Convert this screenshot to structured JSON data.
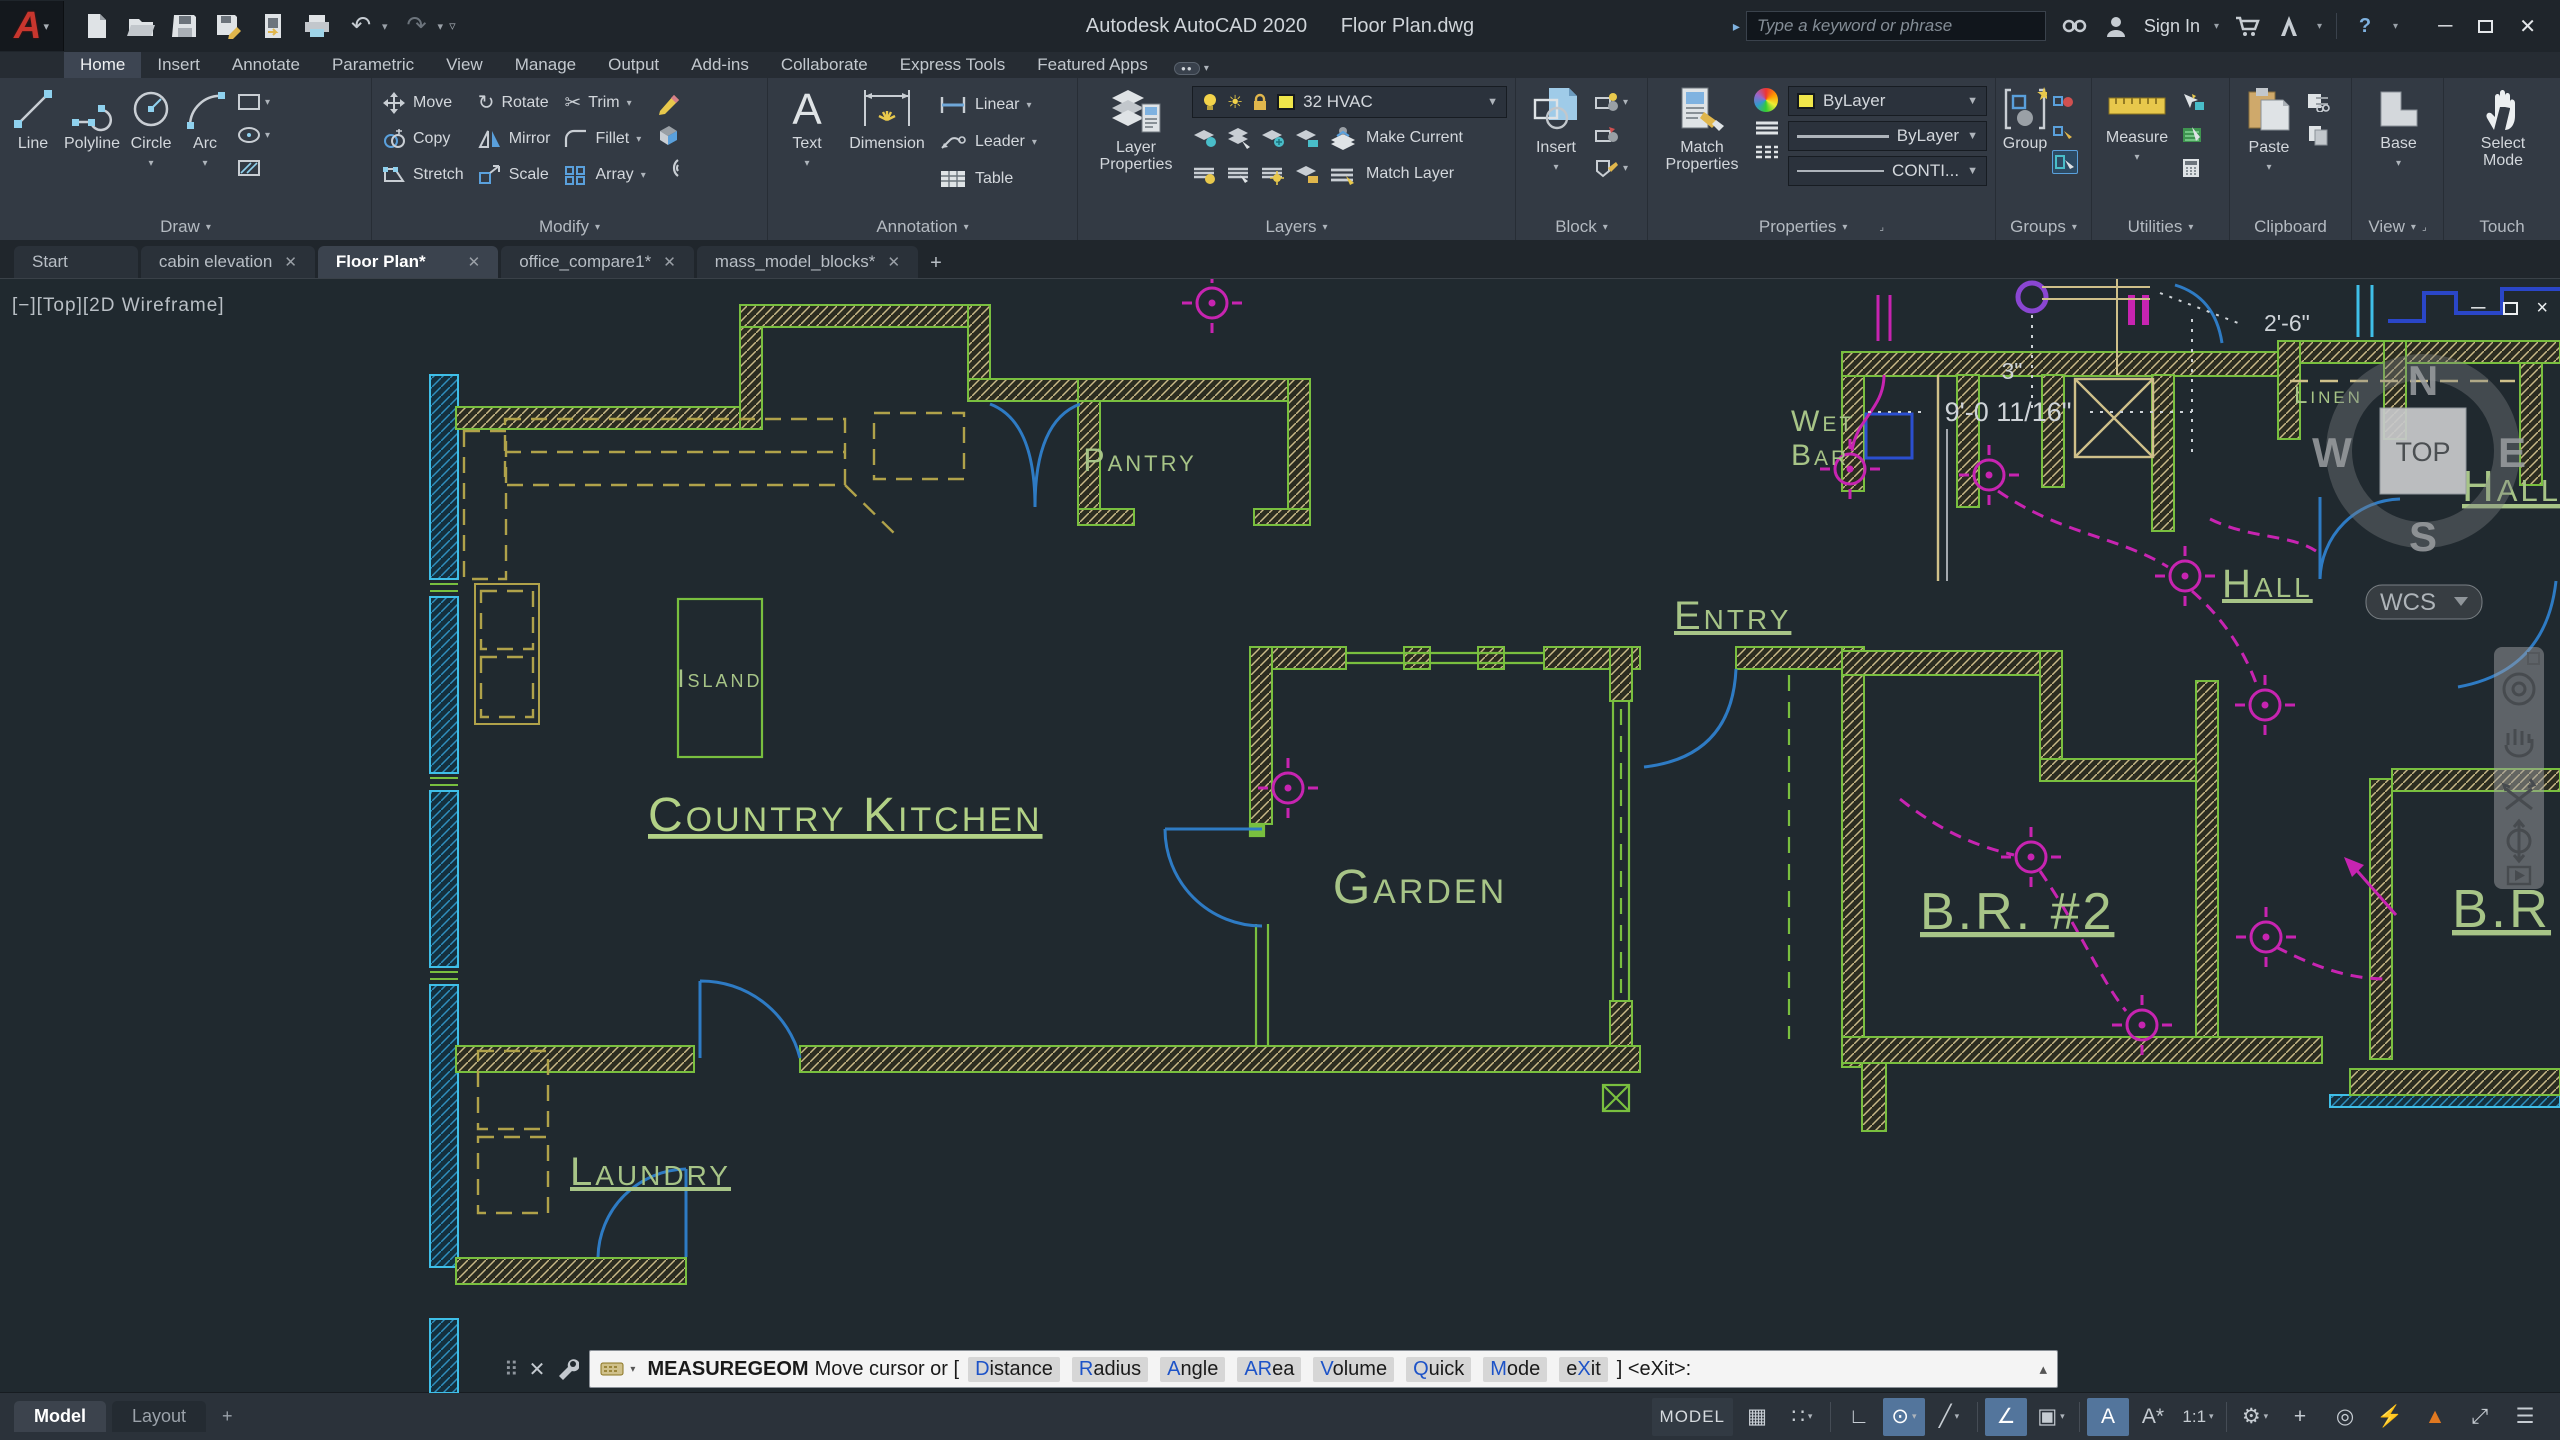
{
  "titlebar": {
    "app_title": "Autodesk AutoCAD 2020",
    "doc_title": "Floor Plan.dwg",
    "search_placeholder": "Type a keyword or phrase",
    "sign_in_label": "Sign In",
    "icons": [
      "application-menu",
      "new",
      "open",
      "save",
      "save-as",
      "export",
      "print",
      "undo",
      "redo",
      "customize",
      "search",
      "binoculars",
      "user",
      "cart",
      "exchange",
      "help",
      "minimize",
      "maximize",
      "close"
    ]
  },
  "ribbon_tabs": [
    {
      "label": "Home",
      "active": true
    },
    {
      "label": "Insert"
    },
    {
      "label": "Annotate"
    },
    {
      "label": "Parametric"
    },
    {
      "label": "View"
    },
    {
      "label": "Manage"
    },
    {
      "label": "Output"
    },
    {
      "label": "Add-ins"
    },
    {
      "label": "Collaborate"
    },
    {
      "label": "Express Tools"
    },
    {
      "label": "Featured Apps"
    }
  ],
  "ribbon": {
    "draw": {
      "title": "Draw",
      "line": "Line",
      "polyline": "Polyline",
      "circle": "Circle",
      "arc": "Arc"
    },
    "modify": {
      "title": "Modify",
      "move": "Move",
      "copy": "Copy",
      "stretch": "Stretch",
      "rotate": "Rotate",
      "mirror": "Mirror",
      "scale": "Scale",
      "trim": "Trim",
      "fillet": "Fillet",
      "array": "Array"
    },
    "annotation": {
      "title": "Annotation",
      "text": "Text",
      "dimension": "Dimension",
      "linear": "Linear",
      "leader": "Leader",
      "table": "Table"
    },
    "layers": {
      "title": "Layers",
      "layer_properties": "Layer Properties",
      "current_layer": "32 HVAC",
      "make_current": "Make Current",
      "match_layer": "Match Layer"
    },
    "block": {
      "title": "Block",
      "insert": "Insert"
    },
    "properties": {
      "title": "Properties",
      "match_properties": "Match Properties",
      "color": "ByLayer",
      "lineweight": "ByLayer",
      "linetype": "CONTI..."
    },
    "groups": {
      "title": "Groups",
      "group": "Group"
    },
    "utilities": {
      "title": "Utilities",
      "measure": "Measure"
    },
    "clipboard": {
      "title": "Clipboard",
      "paste": "Paste"
    },
    "view": {
      "title": "View",
      "base": "Base"
    },
    "touch": {
      "title": "Touch",
      "select_mode": "Select Mode"
    }
  },
  "file_tabs": [
    {
      "label": "Start"
    },
    {
      "label": "cabin elevation"
    },
    {
      "label": "Floor Plan*",
      "active": true
    },
    {
      "label": "office_compare1*"
    },
    {
      "label": "mass_model_blocks*"
    }
  ],
  "viewport": {
    "view_controls": "[−][Top][2D Wireframe]",
    "viewcube": {
      "top": "TOP",
      "north": "N",
      "south": "S",
      "east": "E",
      "west": "W",
      "wcs": "WCS"
    },
    "labels": {
      "pantry": "Pantry",
      "island": "Island",
      "country_kitchen": "Country Kitchen",
      "garden": "Garden",
      "entry": "Entry",
      "laundry": "Laundry",
      "wet": "Wet",
      "bar": "Bar",
      "hall": "Hall",
      "br2": "B.R. #2",
      "br_edge": "B.R",
      "linen": "Linen",
      "hall_edge": "Hall B"
    },
    "dimensions": {
      "dim1": "2'-6\"",
      "dim2": "3\"",
      "dim3": "9'-0 11/16\""
    }
  },
  "command_line": {
    "command": "MEASUREGEOM",
    "prompt_prefix": "Move cursor or [",
    "options": [
      {
        "pre": "",
        "hot": "D",
        "post": "istance"
      },
      {
        "pre": "",
        "hot": "R",
        "post": "adius"
      },
      {
        "pre": "",
        "hot": "A",
        "post": "ngle"
      },
      {
        "pre": "",
        "hot": "AR",
        "post": "ea"
      },
      {
        "pre": "",
        "hot": "V",
        "post": "olume"
      },
      {
        "pre": "",
        "hot": "Q",
        "post": "uick"
      },
      {
        "pre": "",
        "hot": "M",
        "post": "ode"
      },
      {
        "pre": "e",
        "hot": "X",
        "post": "it"
      }
    ],
    "prompt_suffix": "] <eXit>:"
  },
  "status_bar": {
    "model_tab": "Model",
    "layout_tab": "Layout",
    "model_badge": "MODEL",
    "icons": [
      {
        "name": "grid",
        "glyph": "▦"
      },
      {
        "name": "snap",
        "glyph": "∷"
      },
      {
        "name": "ortho",
        "glyph": "∟"
      },
      {
        "name": "polar-tracking",
        "glyph": "⊙",
        "active": true
      },
      {
        "name": "isometric-drafting",
        "glyph": "╱"
      },
      {
        "name": "object-snap-tracking",
        "glyph": "∠",
        "active": true
      },
      {
        "name": "object-snap",
        "glyph": "▣"
      },
      {
        "name": "annotation-visibility",
        "glyph": "A",
        "active": true
      },
      {
        "name": "annotation-autoscale",
        "glyph": "A*"
      },
      {
        "name": "annotation-scale",
        "glyph": "1:1"
      },
      {
        "name": "workspace",
        "glyph": "⚙"
      },
      {
        "name": "crosshair",
        "glyph": "+"
      },
      {
        "name": "isolate-objects",
        "glyph": "◎"
      },
      {
        "name": "graphics-performance",
        "glyph": "⚡"
      },
      {
        "name": "clean-screen",
        "glyph": "▲"
      },
      {
        "name": "fullscreen",
        "glyph": "⤢"
      },
      {
        "name": "menu",
        "glyph": "☰"
      }
    ]
  },
  "colors": {
    "wall_green": "#79bf3f",
    "wall_hatch_tan": "#c9b987",
    "exterior_teal": "#3fbfe8",
    "door_blue": "#2e7bc4",
    "hvac_magenta": "#c724b1",
    "label_green": "#a7c487",
    "layer_yellow": "#f0e64a",
    "active_toggle_blue": "#53759c"
  }
}
